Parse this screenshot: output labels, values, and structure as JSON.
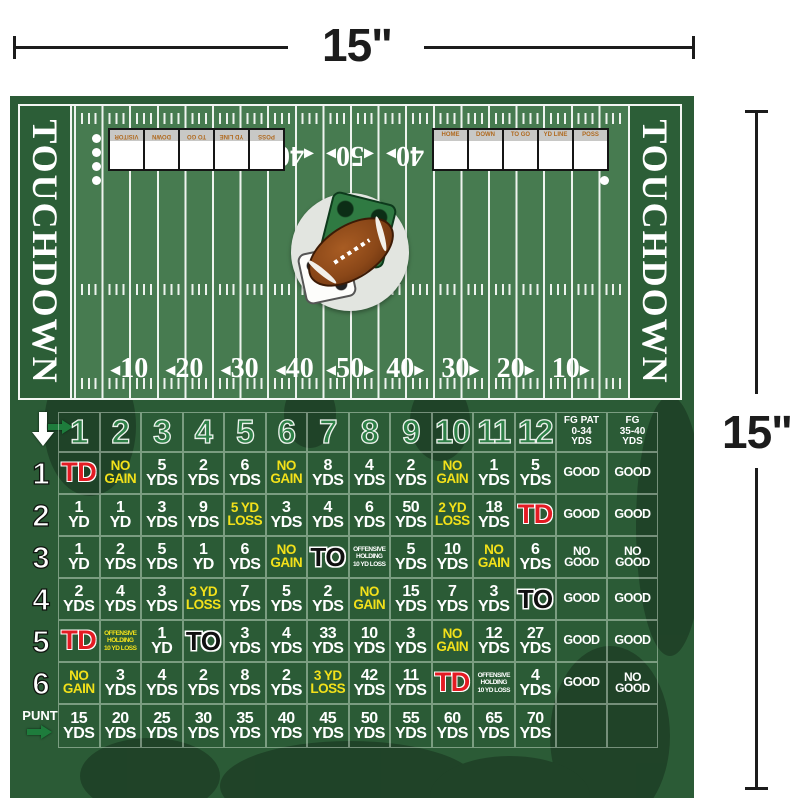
{
  "dimensions": {
    "width_label": "15\"",
    "height_label": "15\""
  },
  "colors": {
    "field_green": "#477b50",
    "dark_green": "#2c5e37",
    "board_green": "#2b5b36",
    "td_red": "#e31b23",
    "result_yellow": "#f3e11a",
    "box_label_orange": "#b06a20",
    "header_number_green": "#2e8047",
    "line_white": "#eef3ee"
  },
  "field": {
    "endzone_left_label": "TOUCHDOWN",
    "endzone_right_label": "TOUCHDOWN",
    "yard_numbers_bottom": [
      {
        "n": "10",
        "a": "l"
      },
      {
        "n": "20",
        "a": "l"
      },
      {
        "n": "30",
        "a": "l"
      },
      {
        "n": "40",
        "a": "l"
      },
      {
        "n": "50",
        "a": "lr"
      },
      {
        "n": "40",
        "a": "r"
      },
      {
        "n": "30",
        "a": "r"
      },
      {
        "n": "20",
        "a": "r"
      },
      {
        "n": "10",
        "a": "r"
      }
    ],
    "yard_numbers_top": [
      {
        "n": "40",
        "a": "l",
        "pos": 40
      },
      {
        "n": "50",
        "a": "lr",
        "pos": 50
      },
      {
        "n": "40",
        "a": "r",
        "pos": 60
      }
    ],
    "scorebox_labels_left": [
      "VISITOR",
      "DOWN",
      "TO GO",
      "YD LINE",
      "POSS"
    ],
    "scorebox_labels_right": [
      "HOME",
      "DOWN",
      "TO GO",
      "YD LINE",
      "POSS"
    ],
    "quarter_dots_per_side": 4
  },
  "table": {
    "col_headers": [
      "1",
      "2",
      "3",
      "4",
      "5",
      "6",
      "7",
      "8",
      "9",
      "10",
      "11",
      "12"
    ],
    "fg_headers": [
      [
        "FG PAT",
        "0-34",
        "YDS"
      ],
      [
        "FG",
        "35-40",
        "YDS"
      ]
    ],
    "row_labels": [
      "1",
      "2",
      "3",
      "4",
      "5",
      "6"
    ],
    "punt_label": "PUNT",
    "rows": [
      [
        {
          "t": "TD",
          "s": "r"
        },
        {
          "t": "NO|GAIN",
          "s": "y"
        },
        {
          "t": "5|YDS",
          "s": "w"
        },
        {
          "t": "2|YDS",
          "s": "w"
        },
        {
          "t": "6|YDS",
          "s": "w"
        },
        {
          "t": "NO|GAIN",
          "s": "y"
        },
        {
          "t": "8|YDS",
          "s": "w"
        },
        {
          "t": "4|YDS",
          "s": "w"
        },
        {
          "t": "2|YDS",
          "s": "w"
        },
        {
          "t": "NO|GAIN",
          "s": "y"
        },
        {
          "t": "1|YDS",
          "s": "w"
        },
        {
          "t": "5|YDS",
          "s": "w"
        },
        {
          "t": "GOOD",
          "s": "g"
        },
        {
          "t": "GOOD",
          "s": "g"
        }
      ],
      [
        {
          "t": "1|YD",
          "s": "w"
        },
        {
          "t": "1|YD",
          "s": "w"
        },
        {
          "t": "3|YDS",
          "s": "w"
        },
        {
          "t": "9|YDS",
          "s": "w"
        },
        {
          "t": "5 YD|LOSS",
          "s": "y"
        },
        {
          "t": "3|YDS",
          "s": "w"
        },
        {
          "t": "4|YDS",
          "s": "w"
        },
        {
          "t": "6|YDS",
          "s": "w"
        },
        {
          "t": "50|YDS",
          "s": "w"
        },
        {
          "t": "2 YD|LOSS",
          "s": "y"
        },
        {
          "t": "18|YDS",
          "s": "w"
        },
        {
          "t": "TD",
          "s": "r"
        },
        {
          "t": "GOOD",
          "s": "g"
        },
        {
          "t": "GOOD",
          "s": "g"
        }
      ],
      [
        {
          "t": "1|YD",
          "s": "w"
        },
        {
          "t": "2|YDS",
          "s": "w"
        },
        {
          "t": "5|YDS",
          "s": "w"
        },
        {
          "t": "1|YD",
          "s": "w"
        },
        {
          "t": "6|YDS",
          "s": "w"
        },
        {
          "t": "NO|GAIN",
          "s": "y"
        },
        {
          "t": "TO",
          "s": "k"
        },
        {
          "t": "OFFENSIVE|HOLDING|10 YD LOSS",
          "s": "pw"
        },
        {
          "t": "5|YDS",
          "s": "w"
        },
        {
          "t": "10|YDS",
          "s": "w"
        },
        {
          "t": "NO|GAIN",
          "s": "y"
        },
        {
          "t": "6|YDS",
          "s": "w"
        },
        {
          "t": "NO|GOOD",
          "s": "ng"
        },
        {
          "t": "NO|GOOD",
          "s": "ng"
        }
      ],
      [
        {
          "t": "2|YDS",
          "s": "w"
        },
        {
          "t": "4|YDS",
          "s": "w"
        },
        {
          "t": "3|YDS",
          "s": "w"
        },
        {
          "t": "3 YD|LOSS",
          "s": "y"
        },
        {
          "t": "7|YDS",
          "s": "w"
        },
        {
          "t": "5|YDS",
          "s": "w"
        },
        {
          "t": "2|YDS",
          "s": "w"
        },
        {
          "t": "NO|GAIN",
          "s": "y"
        },
        {
          "t": "15|YDS",
          "s": "w"
        },
        {
          "t": "7|YDS",
          "s": "w"
        },
        {
          "t": "3|YDS",
          "s": "w"
        },
        {
          "t": "TO",
          "s": "k"
        },
        {
          "t": "GOOD",
          "s": "g"
        },
        {
          "t": "GOOD",
          "s": "g"
        }
      ],
      [
        {
          "t": "TD",
          "s": "r"
        },
        {
          "t": "OFFENSIVE|HOLDING|10 YD LOSS",
          "s": "py"
        },
        {
          "t": "1|YD",
          "s": "w"
        },
        {
          "t": "TO",
          "s": "k"
        },
        {
          "t": "3|YDS",
          "s": "w"
        },
        {
          "t": "4|YDS",
          "s": "w"
        },
        {
          "t": "33|YDS",
          "s": "w"
        },
        {
          "t": "10|YDS",
          "s": "w"
        },
        {
          "t": "3|YDS",
          "s": "w"
        },
        {
          "t": "NO|GAIN",
          "s": "y"
        },
        {
          "t": "12|YDS",
          "s": "w"
        },
        {
          "t": "27|YDS",
          "s": "w"
        },
        {
          "t": "GOOD",
          "s": "g"
        },
        {
          "t": "GOOD",
          "s": "g"
        }
      ],
      [
        {
          "t": "NO|GAIN",
          "s": "y"
        },
        {
          "t": "3|YDS",
          "s": "w"
        },
        {
          "t": "4|YDS",
          "s": "w"
        },
        {
          "t": "2|YDS",
          "s": "w"
        },
        {
          "t": "8|YDS",
          "s": "w"
        },
        {
          "t": "2|YDS",
          "s": "w"
        },
        {
          "t": "3 YD|LOSS",
          "s": "y"
        },
        {
          "t": "42|YDS",
          "s": "w"
        },
        {
          "t": "11|YDS",
          "s": "w"
        },
        {
          "t": "TD",
          "s": "r"
        },
        {
          "t": "OFFENSIVE|HOLDING|10 YD LOSS",
          "s": "pw"
        },
        {
          "t": "4|YDS",
          "s": "w"
        },
        {
          "t": "GOOD",
          "s": "g"
        },
        {
          "t": "NO|GOOD",
          "s": "ng"
        }
      ]
    ],
    "punt_row": [
      {
        "t": "15|YDS",
        "s": "w"
      },
      {
        "t": "20|YDS",
        "s": "w"
      },
      {
        "t": "25|YDS",
        "s": "w"
      },
      {
        "t": "30|YDS",
        "s": "w"
      },
      {
        "t": "35|YDS",
        "s": "w"
      },
      {
        "t": "40|YDS",
        "s": "w"
      },
      {
        "t": "45|YDS",
        "s": "w"
      },
      {
        "t": "50|YDS",
        "s": "w"
      },
      {
        "t": "55|YDS",
        "s": "w"
      },
      {
        "t": "60|YDS",
        "s": "w"
      },
      {
        "t": "65|YDS",
        "s": "w"
      },
      {
        "t": "70|YDS",
        "s": "w"
      },
      {
        "t": "",
        "s": "e"
      },
      {
        "t": "",
        "s": "e"
      }
    ]
  }
}
